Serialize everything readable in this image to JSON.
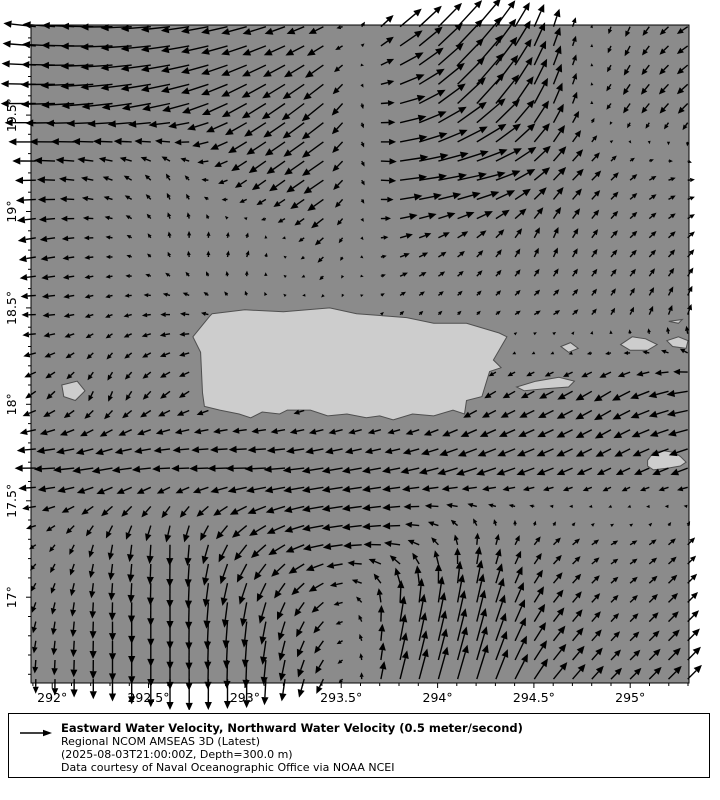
{
  "chart_data": {
    "type": "quiver",
    "title": "",
    "xlabel": "",
    "ylabel": "",
    "xlim": [
      291.89,
      295.305
    ],
    "ylim": [
      16.555,
      19.967
    ],
    "x_tick_values": [
      292,
      292.5,
      293,
      293.5,
      294,
      294.5,
      295
    ],
    "x_tick_labels": [
      "292°",
      "292.5°",
      "293°",
      "293.5°",
      "294°",
      "294.5°",
      "295°"
    ],
    "y_tick_values": [
      17,
      17.5,
      18,
      18.5,
      19,
      19.5
    ],
    "y_tick_labels": [
      "17°",
      "17.5°",
      "18°",
      "18.5°",
      "19°",
      "19.5°"
    ],
    "minor_tick_step": 0.1,
    "arrow_grid_step": 0.0995,
    "reference_speed_mps": 0.5,
    "grid": false,
    "legend_position": "bottom",
    "colors": {
      "sea": "#8b8b8b",
      "land": "#cdcdcd",
      "land_outline": "#4f4f4f",
      "arrow": "#000000",
      "axis": "#000000",
      "background": "#ffffff",
      "legend_bg": "#ffffcc"
    },
    "coarse_field": {
      "comment": "u=eastward, v=northward water velocity (m/s), sampled on lon x lat grid; rows ordered north to south",
      "lon": [
        291.9,
        292.28,
        292.66,
        293.04,
        293.42,
        293.8,
        294.18,
        294.56,
        294.94,
        295.3
      ],
      "lat": [
        19.95,
        19.58,
        19.2,
        18.82,
        18.44,
        18.06,
        17.68,
        17.3,
        16.93,
        16.56
      ],
      "u": [
        [
          -0.45,
          -0.45,
          -0.4,
          -0.35,
          -0.2,
          0.3,
          0.35,
          0.1,
          -0.05,
          -0.15
        ],
        [
          -0.5,
          -0.45,
          -0.4,
          -0.35,
          -0.3,
          0.35,
          0.4,
          0.15,
          -0.1,
          -0.15
        ],
        [
          -0.3,
          -0.15,
          -0.05,
          -0.2,
          -0.3,
          0.4,
          0.45,
          0.2,
          0.1,
          0.1
        ],
        [
          -0.25,
          -0.1,
          0.0,
          0.05,
          -0.1,
          0.15,
          0.1,
          0.05,
          0.1,
          0.1
        ],
        [
          -0.2,
          -0.1,
          -0.15,
          -0.05,
          0.0,
          0.05,
          0.05,
          0.1,
          0.05,
          0.05
        ],
        [
          -0.15,
          -0.05,
          -0.15,
          -0.1,
          -0.1,
          -0.1,
          -0.15,
          -0.2,
          -0.25,
          -0.3
        ],
        [
          -0.3,
          -0.3,
          -0.25,
          -0.3,
          -0.3,
          -0.25,
          -0.3,
          -0.25,
          -0.2,
          -0.25
        ],
        [
          -0.1,
          -0.05,
          0.0,
          -0.2,
          -0.3,
          -0.25,
          0.0,
          0.1,
          0.1,
          0.1
        ],
        [
          -0.05,
          0.0,
          0.0,
          -0.05,
          -0.15,
          0.05,
          0.1,
          0.15,
          0.1,
          0.15
        ],
        [
          0.0,
          0.0,
          0.0,
          0.0,
          -0.1,
          0.1,
          0.15,
          0.2,
          0.15,
          0.2
        ]
      ],
      "v": [
        [
          0.05,
          0.0,
          -0.05,
          -0.1,
          -0.1,
          0.25,
          0.4,
          0.3,
          -0.15,
          -0.1
        ],
        [
          0.0,
          -0.05,
          -0.1,
          -0.2,
          -0.25,
          0.1,
          0.45,
          0.35,
          -0.15,
          -0.15
        ],
        [
          0.0,
          0.05,
          0.1,
          -0.15,
          -0.2,
          0.05,
          0.1,
          0.2,
          0.1,
          0.0
        ],
        [
          -0.05,
          0.0,
          0.1,
          0.1,
          -0.1,
          0.05,
          0.1,
          0.15,
          0.1,
          0.1
        ],
        [
          0.0,
          -0.05,
          0.0,
          0.05,
          0.0,
          0.05,
          0.05,
          0.05,
          0.1,
          0.15
        ],
        [
          -0.1,
          -0.15,
          -0.1,
          -0.05,
          -0.05,
          -0.05,
          -0.1,
          -0.1,
          -0.15,
          -0.05
        ],
        [
          0.0,
          -0.05,
          0.0,
          0.0,
          -0.05,
          -0.05,
          -0.1,
          -0.1,
          -0.1,
          -0.1
        ],
        [
          -0.05,
          -0.2,
          -0.3,
          -0.2,
          -0.05,
          0.0,
          0.15,
          0.1,
          0.05,
          0.1
        ],
        [
          -0.15,
          -0.25,
          -0.4,
          -0.35,
          -0.15,
          0.35,
          0.45,
          0.2,
          0.1,
          0.15
        ],
        [
          -0.2,
          -0.3,
          -0.45,
          -0.4,
          -0.2,
          0.4,
          0.5,
          0.25,
          0.15,
          0.2
        ]
      ]
    },
    "land_polygons": [
      {
        "name": "puerto-rico",
        "points": [
          [
            292.83,
            18.47
          ],
          [
            293.0,
            18.49
          ],
          [
            293.2,
            18.48
          ],
          [
            293.44,
            18.5
          ],
          [
            293.58,
            18.47
          ],
          [
            293.84,
            18.45
          ],
          [
            293.98,
            18.42
          ],
          [
            294.15,
            18.42
          ],
          [
            294.32,
            18.37
          ],
          [
            294.36,
            18.35
          ],
          [
            294.29,
            18.23
          ],
          [
            294.33,
            18.19
          ],
          [
            294.27,
            18.17
          ],
          [
            294.23,
            18.04
          ],
          [
            294.15,
            18.02
          ],
          [
            294.14,
            17.95
          ],
          [
            294.08,
            17.97
          ],
          [
            293.98,
            17.94
          ],
          [
            293.87,
            17.95
          ],
          [
            293.77,
            17.92
          ],
          [
            293.7,
            17.94
          ],
          [
            293.63,
            17.93
          ],
          [
            293.53,
            17.95
          ],
          [
            293.43,
            17.94
          ],
          [
            293.34,
            17.97
          ],
          [
            293.22,
            17.97
          ],
          [
            293.18,
            17.95
          ],
          [
            293.09,
            17.96
          ],
          [
            293.03,
            17.93
          ],
          [
            292.97,
            17.95
          ],
          [
            292.87,
            17.97
          ],
          [
            292.79,
            17.99
          ],
          [
            292.78,
            18.06
          ],
          [
            292.77,
            18.27
          ],
          [
            292.73,
            18.35
          ],
          [
            292.82,
            18.46
          ]
        ]
      },
      {
        "name": "mona",
        "points": [
          [
            292.05,
            18.1
          ],
          [
            292.13,
            18.12
          ],
          [
            292.17,
            18.07
          ],
          [
            292.12,
            18.02
          ],
          [
            292.06,
            18.04
          ]
        ]
      },
      {
        "name": "vieques",
        "points": [
          [
            294.41,
            18.09
          ],
          [
            294.51,
            18.12
          ],
          [
            294.63,
            18.14
          ],
          [
            294.71,
            18.12
          ],
          [
            294.68,
            18.09
          ],
          [
            294.55,
            18.08
          ],
          [
            294.45,
            18.07
          ]
        ]
      },
      {
        "name": "culebra",
        "points": [
          [
            294.64,
            18.3
          ],
          [
            294.69,
            18.32
          ],
          [
            294.73,
            18.29
          ],
          [
            294.68,
            18.27
          ]
        ]
      },
      {
        "name": "st-thomas",
        "points": [
          [
            294.95,
            18.31
          ],
          [
            295.01,
            18.35
          ],
          [
            295.08,
            18.34
          ],
          [
            295.14,
            18.31
          ],
          [
            295.09,
            18.28
          ],
          [
            295.0,
            18.28
          ]
        ]
      },
      {
        "name": "tortola",
        "points": [
          [
            295.19,
            18.33
          ],
          [
            295.25,
            18.35
          ],
          [
            295.3,
            18.33
          ],
          [
            295.29,
            18.29
          ],
          [
            295.22,
            18.3
          ]
        ]
      },
      {
        "name": "anegada",
        "points": [
          [
            295.2,
            18.43
          ],
          [
            295.27,
            18.44
          ],
          [
            295.25,
            18.42
          ]
        ]
      },
      {
        "name": "st-croix",
        "points": [
          [
            295.09,
            17.71
          ],
          [
            295.12,
            17.75
          ],
          [
            295.17,
            17.76
          ],
          [
            295.23,
            17.75
          ],
          [
            295.26,
            17.73
          ],
          [
            295.29,
            17.7
          ],
          [
            295.26,
            17.68
          ],
          [
            295.2,
            17.67
          ],
          [
            295.12,
            17.66
          ],
          [
            295.09,
            17.68
          ]
        ]
      }
    ]
  },
  "legend": {
    "title": "Eastward Water Velocity, Northward Water Velocity (0.5 meter/second)",
    "model": "Regional NCOM AMSEAS 3D (Latest)",
    "timestamp": "(2025-08-03T21:00:00Z, Depth=300.0 m)",
    "credit": "Data courtesy of Naval Oceanographic Office via NOAA NCEI"
  }
}
